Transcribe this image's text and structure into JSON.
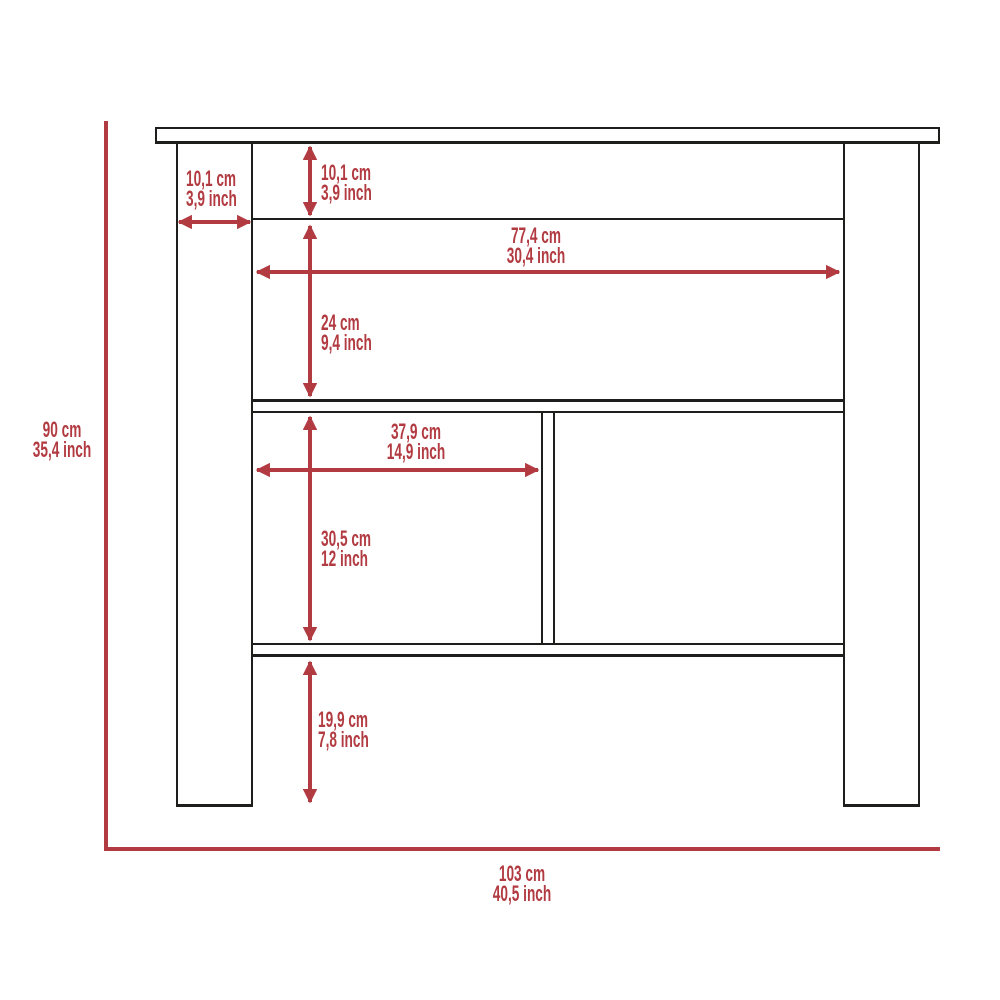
{
  "colors": {
    "dimension": "#b23b42",
    "outline": "#1e1e1c",
    "background": "#ffffff"
  },
  "figure": {
    "type": "furniture-dimension-diagram",
    "subject": "kitchen-island-console-front-view",
    "dimensions": {
      "leg_width": {
        "cm": "10,1 cm",
        "inch": "3,9 inch"
      },
      "top_rail_height": {
        "cm": "10,1 cm",
        "inch": "3,9 inch"
      },
      "inner_width": {
        "cm": "77,4 cm",
        "inch": "30,4 inch"
      },
      "upper_shelf_height": {
        "cm": "24 cm",
        "inch": "9,4 inch"
      },
      "left_cubby_width": {
        "cm": "37,9 cm",
        "inch": "14,9 inch"
      },
      "lower_cubby_height": {
        "cm": "30,5 cm",
        "inch": "12 inch"
      },
      "bottom_clearance": {
        "cm": "19,9 cm",
        "inch": "7,8 inch"
      },
      "overall_height": {
        "cm": "90 cm",
        "inch": "35,4 inch"
      },
      "overall_width": {
        "cm": "103 cm",
        "inch": "40,5 inch"
      }
    }
  }
}
